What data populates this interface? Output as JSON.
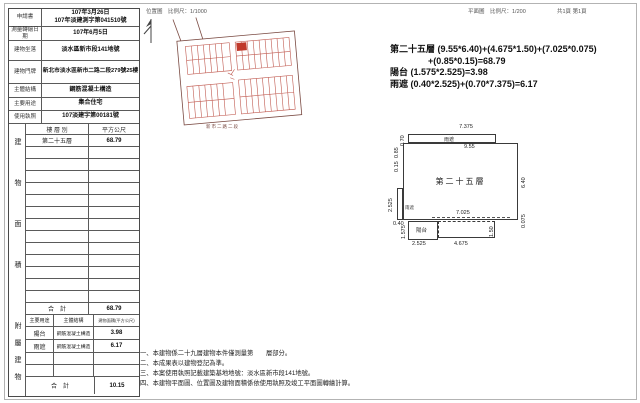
{
  "header": {
    "location_map_title": "位置圖　比例尺：1/1000",
    "floor_plan_title": "平面圖　比例尺：1/200",
    "page_info": "共1頁 第1頁"
  },
  "info": {
    "rows": [
      {
        "label": "申請書",
        "line1": "107年3月26日",
        "line2": "107年淡建測字第041510號"
      },
      {
        "label": "測量轉繪日期",
        "value": "107年6月5日"
      },
      {
        "label": "建物坐落",
        "value": "淡水區新市段141地號"
      },
      {
        "label": "建物門牌",
        "value": "新北市淡水區新市二路二段279號25樓"
      },
      {
        "label": "主體結構",
        "value": "鋼筋混凝土構造"
      },
      {
        "label": "主要用途",
        "value": "集合住宅"
      },
      {
        "label": "使用執照",
        "value": "107淡建字第00181號"
      }
    ]
  },
  "floor_table": {
    "section_label": "建物面積",
    "col_floor": "樓 層 別",
    "col_area": "平方公尺",
    "floor_name": "第二十五層",
    "floor_area": "68.79",
    "total_label": "合　計",
    "total_area": "68.79"
  },
  "accessory_table": {
    "section_label": "附屬建物",
    "col_use": "主要用途",
    "col_structure": "主體結構",
    "col_area": "建物面積(平方公尺)",
    "rows": [
      {
        "use": "陽台",
        "structure": "鋼筋混凝土構造",
        "area": "3.98"
      },
      {
        "use": "雨遮",
        "structure": "鋼筋混凝土構造",
        "area": "6.17"
      }
    ],
    "total_label": "合　計",
    "total_area": "10.15"
  },
  "map": {
    "street_label": "新市二路二段",
    "line_color": "#7a4a42",
    "building_color": "#c05a50",
    "highlight_color": "#c0392b"
  },
  "formulas": [
    "第二十五層 (9.55*6.40)+(4.675*1.50)+(7.025*0.075)",
    "+(0.85*0.15)=68.79",
    "陽台 (1.575*2.525)=3.98",
    "雨遮 (0.40*2.525)+(0.70*7.375)=6.17"
  ],
  "plan": {
    "room_label": "第二十五層",
    "canopy_label": "雨遮",
    "balcony_label": "陽台",
    "dim_canopy_len": "7.375",
    "dim_canopy_depth": "0.70",
    "dim_main_width": "9.55",
    "dim_notch_h": "0.85",
    "dim_notch_w": "0.15",
    "dim_main_height": "6.40",
    "dim_left_canopy_h": "2.525",
    "dim_left_canopy_w": "0.40",
    "dim_bottom_strip": "7.025",
    "dim_bottom_strip_d": "0.075",
    "dim_balcony_h": "1.575",
    "dim_balcony_w": "2.525",
    "dim_ext_w": "4.675",
    "dim_ext_h": "1.50"
  },
  "notes": [
    "一、本建物係二十九層建物本件僅測量第　　層部分。",
    "二、本成果表以建物登記為準。",
    "三、本案使用執照記載建築基地地號：淡水區新市段141地號。",
    "四、本建物平面圖、位置圖及建物面積係依使用執照及竣工平面圖轉繪計算。"
  ]
}
